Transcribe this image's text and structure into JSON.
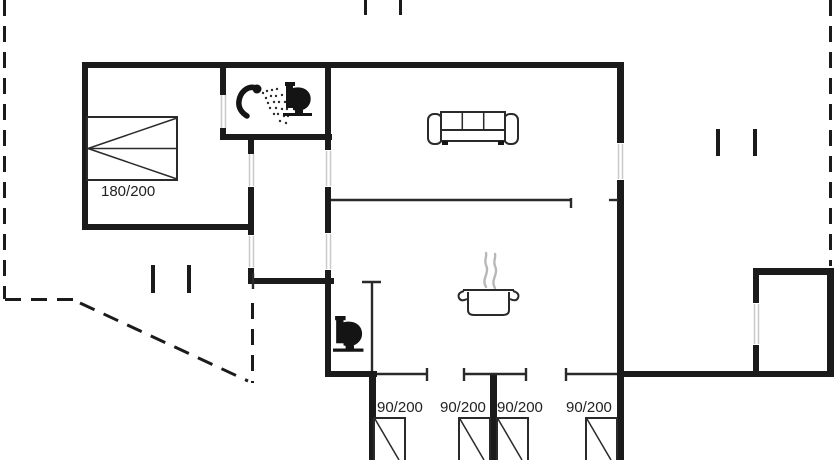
{
  "colors": {
    "bg": "#ffffff",
    "wall": "#1b1b1b",
    "line": "#2a2a2a",
    "jamb": "#c9c9c9",
    "steam": "#b8b8b8",
    "text": "#222222"
  },
  "plan": {
    "type": "holiday-house floor plan",
    "double_bed_label": "180/200",
    "single_bed_labels": [
      "90/200",
      "90/200",
      "90/200",
      "90/200"
    ],
    "icons": [
      "shower-icon",
      "toilet-icon",
      "sofa-icon",
      "cooking-pot-icon",
      "toilet-icon"
    ]
  }
}
